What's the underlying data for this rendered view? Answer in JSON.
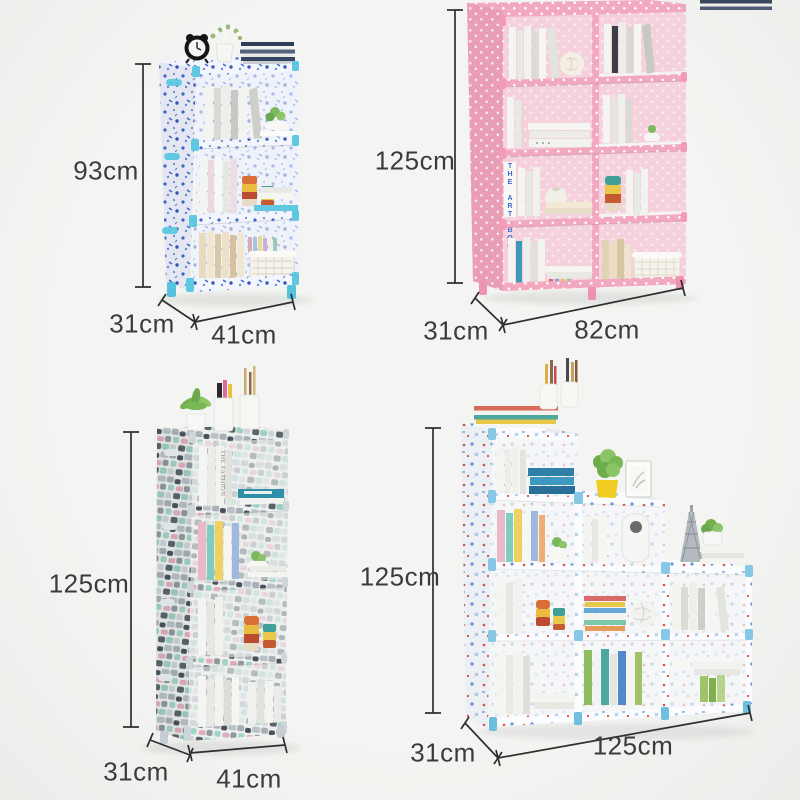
{
  "page": {
    "background_color": "#f1f2ef",
    "annotation_line_color": "#2f2f2f",
    "annotation_text_color": "#3b3b3b"
  },
  "products": [
    {
      "id": "blue-floral-3-cube-shelf",
      "accent_color": "#5ec8e2",
      "fabric_color": "#f2f5fb",
      "dimensions": {
        "height": "93cm",
        "depth": "31cm",
        "width": "41cm"
      }
    },
    {
      "id": "pink-polkadot-8-cube-shelf",
      "accent_color": "#f2a9c0",
      "fabric_color": "#f2a9c0",
      "book_spine_text": "THE ART BOOK",
      "dimensions": {
        "height": "125cm",
        "depth": "31cm",
        "width": "82cm"
      }
    },
    {
      "id": "grey-mosaic-4-cube-shelf",
      "accent_color": "#cfd6da",
      "fabric_color": "#eceeee",
      "book_spine_text": "THE FASHION",
      "dimensions": {
        "height": "125cm",
        "depth": "31cm",
        "width": "41cm"
      }
    },
    {
      "id": "staircase-9-cube-shelf",
      "accent_color": "#86c8e6",
      "fabric_color": "#fbfcfe",
      "dimensions": {
        "height": "125cm",
        "depth": "31cm",
        "width": "125cm"
      }
    }
  ]
}
